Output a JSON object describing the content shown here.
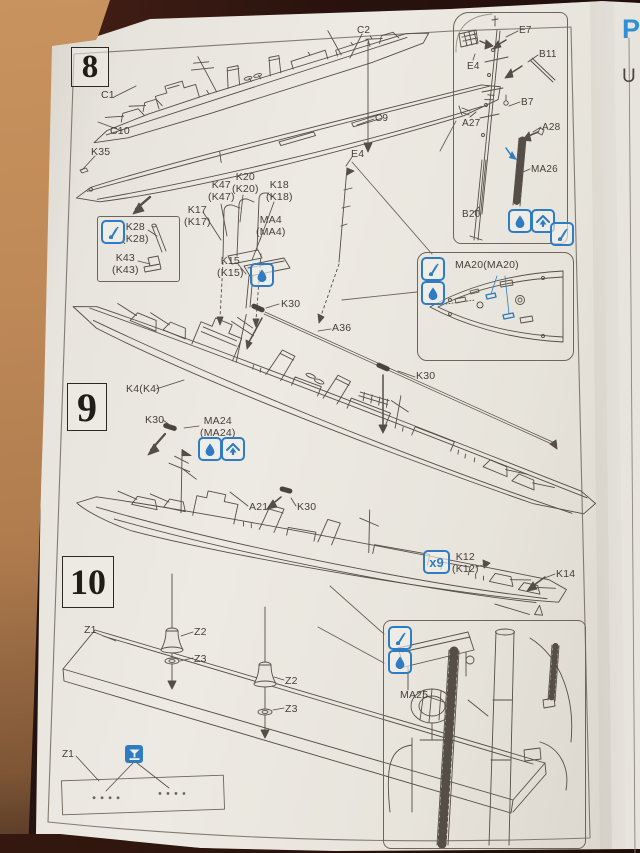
{
  "colors": {
    "accent_blue": "#2f7cc3",
    "ink": "#544e46",
    "paper": "#e9e6df",
    "wood": "#c08f5e"
  },
  "icons": {
    "paint": "paintbrush",
    "glue": "water-drop",
    "fit": "roof-arrow",
    "drill": "funnel-drill"
  },
  "neighbor_page": {
    "heading_fragment": "P",
    "line_fragment": "U"
  },
  "step8": {
    "number": "8",
    "callouts": {
      "c1": "C1",
      "c10": "C10",
      "c2": "C2",
      "c9": "C9",
      "k35": "K35",
      "e4": "E4",
      "k47": "K47\n(K47)",
      "k20": "K20\n(K20)",
      "k18": "K18\n(K18)",
      "k17": "K17\n(K17)",
      "ma4": "MA4\n(MA4)",
      "k15": "K15\n(K15)"
    },
    "paint_box": {
      "k28": "K28\n(K28)",
      "k43": "K43\n(K43)"
    }
  },
  "inset_mast": {
    "callouts": {
      "e7": "E7",
      "e4": "E4",
      "b11": "B11",
      "b7": "B7",
      "a27": "A27",
      "a28": "A28",
      "ma26": "MA26",
      "b20": "B20"
    }
  },
  "inset_bow": {
    "label": "MA20(MA20)"
  },
  "step9": {
    "number": "9",
    "callouts": {
      "k30_fore": "K30",
      "a36": "A36",
      "k30_aft": "K30",
      "k4": "K4(K4)",
      "k30_port": "K30",
      "ma24": "MA24\n(MA24)",
      "a21": "A21",
      "k30_boat": "K30"
    }
  },
  "step10": {
    "number": "10",
    "callouts": {
      "k12_qty": "x9",
      "k12": "K12\n(K12)",
      "k14": "K14",
      "z1": "Z1",
      "z2_fore": "Z2",
      "z3_fore": "Z3",
      "z2_aft": "Z2",
      "z3_aft": "Z3",
      "z1_plate": "Z1"
    }
  },
  "inset_detail": {
    "label": "MA25"
  }
}
